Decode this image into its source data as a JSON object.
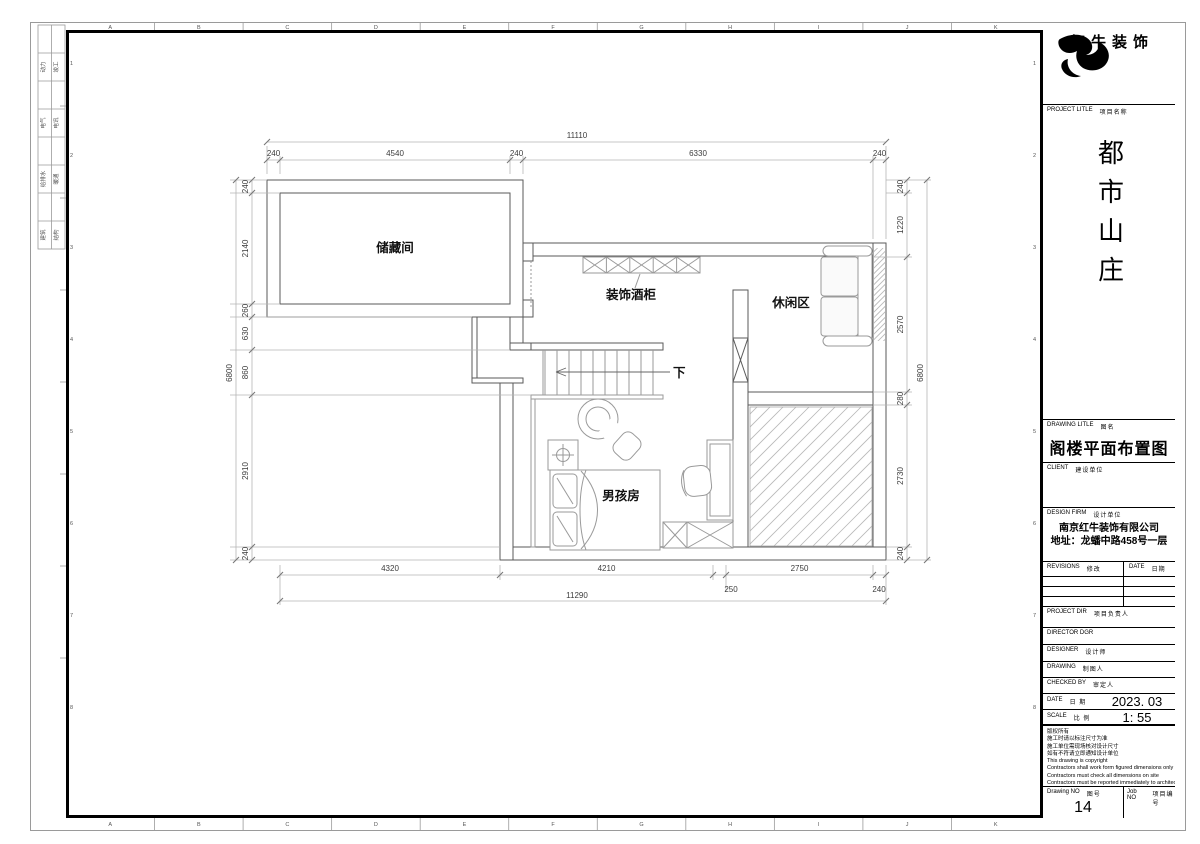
{
  "sheet": {
    "border_letters": [
      "A",
      "B",
      "C",
      "D",
      "E",
      "F",
      "G",
      "H",
      "I",
      "J",
      "K"
    ],
    "border_numbers": [
      "1",
      "2",
      "3",
      "4",
      "5",
      "6",
      "7",
      "8"
    ],
    "discipline_table": [
      [
        "动力",
        "竣工"
      ],
      [
        "电气",
        "电讯"
      ],
      [
        "给排水",
        "暖通"
      ],
      [
        "建筑",
        "结构"
      ]
    ]
  },
  "plan": {
    "rooms": {
      "storage": "储藏间",
      "wine_cabinet": "装饰酒柜",
      "leisure": "休闲区",
      "boy": "男孩房",
      "down": "下"
    },
    "dimensions": {
      "top_total": "11110",
      "top_segments": [
        "240",
        "4540",
        "240",
        "6330",
        "240"
      ],
      "left_total": "6800",
      "left_segments": [
        "240",
        "2140",
        "260",
        "630",
        "860",
        "2910",
        "240"
      ],
      "right_total": "6800",
      "right_segments": [
        "240",
        "1220",
        "2570",
        "280",
        "2730",
        "240"
      ],
      "bottom_segments": [
        "4320",
        "4210",
        "2750"
      ],
      "bottom_sub_segments": [
        "250",
        "240"
      ],
      "bottom_total": "11290"
    }
  },
  "title_block": {
    "logo_text": "红牛装饰",
    "project_label": "PROJECT LITLE",
    "project_label_cn": "项目名称",
    "project_name": "都市山庄",
    "drawing_title_label": "DRAWING LITLE",
    "drawing_title_label_cn": "图名",
    "drawing_title": "阁楼平面布置图",
    "client_label": "CLIENT",
    "client_label_cn": "建设单位",
    "design_firm_label": "DESIGN FIRM",
    "design_firm_label_cn": "设计单位",
    "design_firm_name": "南京红牛装饰有限公司",
    "design_firm_address": "地址：龙蟠中路458号一层",
    "revisions_label": "REVISIONS",
    "revisions_label_cn": "修改",
    "date_col_label": "DATE",
    "date_col_label_cn": "日期",
    "rows": [
      {
        "label": "PROJECT DIR",
        "cn": "项目负责人"
      },
      {
        "label": "DIRECTOR DGR",
        "cn": ""
      },
      {
        "label": "DESIGNER",
        "cn": "设计师"
      },
      {
        "label": "DRAWING",
        "cn": "制图人"
      },
      {
        "label": "CHECKED BY",
        "cn": "审定人"
      }
    ],
    "date_label": "DATE",
    "date_label_cn": "日 期",
    "date_value": "2023. 03",
    "scale_label": "SCALE",
    "scale_label_cn": "比 例",
    "scale_value": "1:  55",
    "notes": [
      "版权所有",
      "施工时请以标注尺寸为准",
      "施工单位需现场核对设计尺寸",
      "如有不符请立即通知设计单位",
      "This drawing is copyright",
      "Contractors shall work form figured dimensions only",
      "Contractors must check all dimensions on site",
      "Contractors must be reported immediately to architects"
    ],
    "drawing_no_label": "Drawing NO",
    "drawing_no_label_cn": "图号",
    "drawing_no": "14",
    "job_no_label": "Job NO",
    "job_no_label_cn": "项目编号"
  }
}
